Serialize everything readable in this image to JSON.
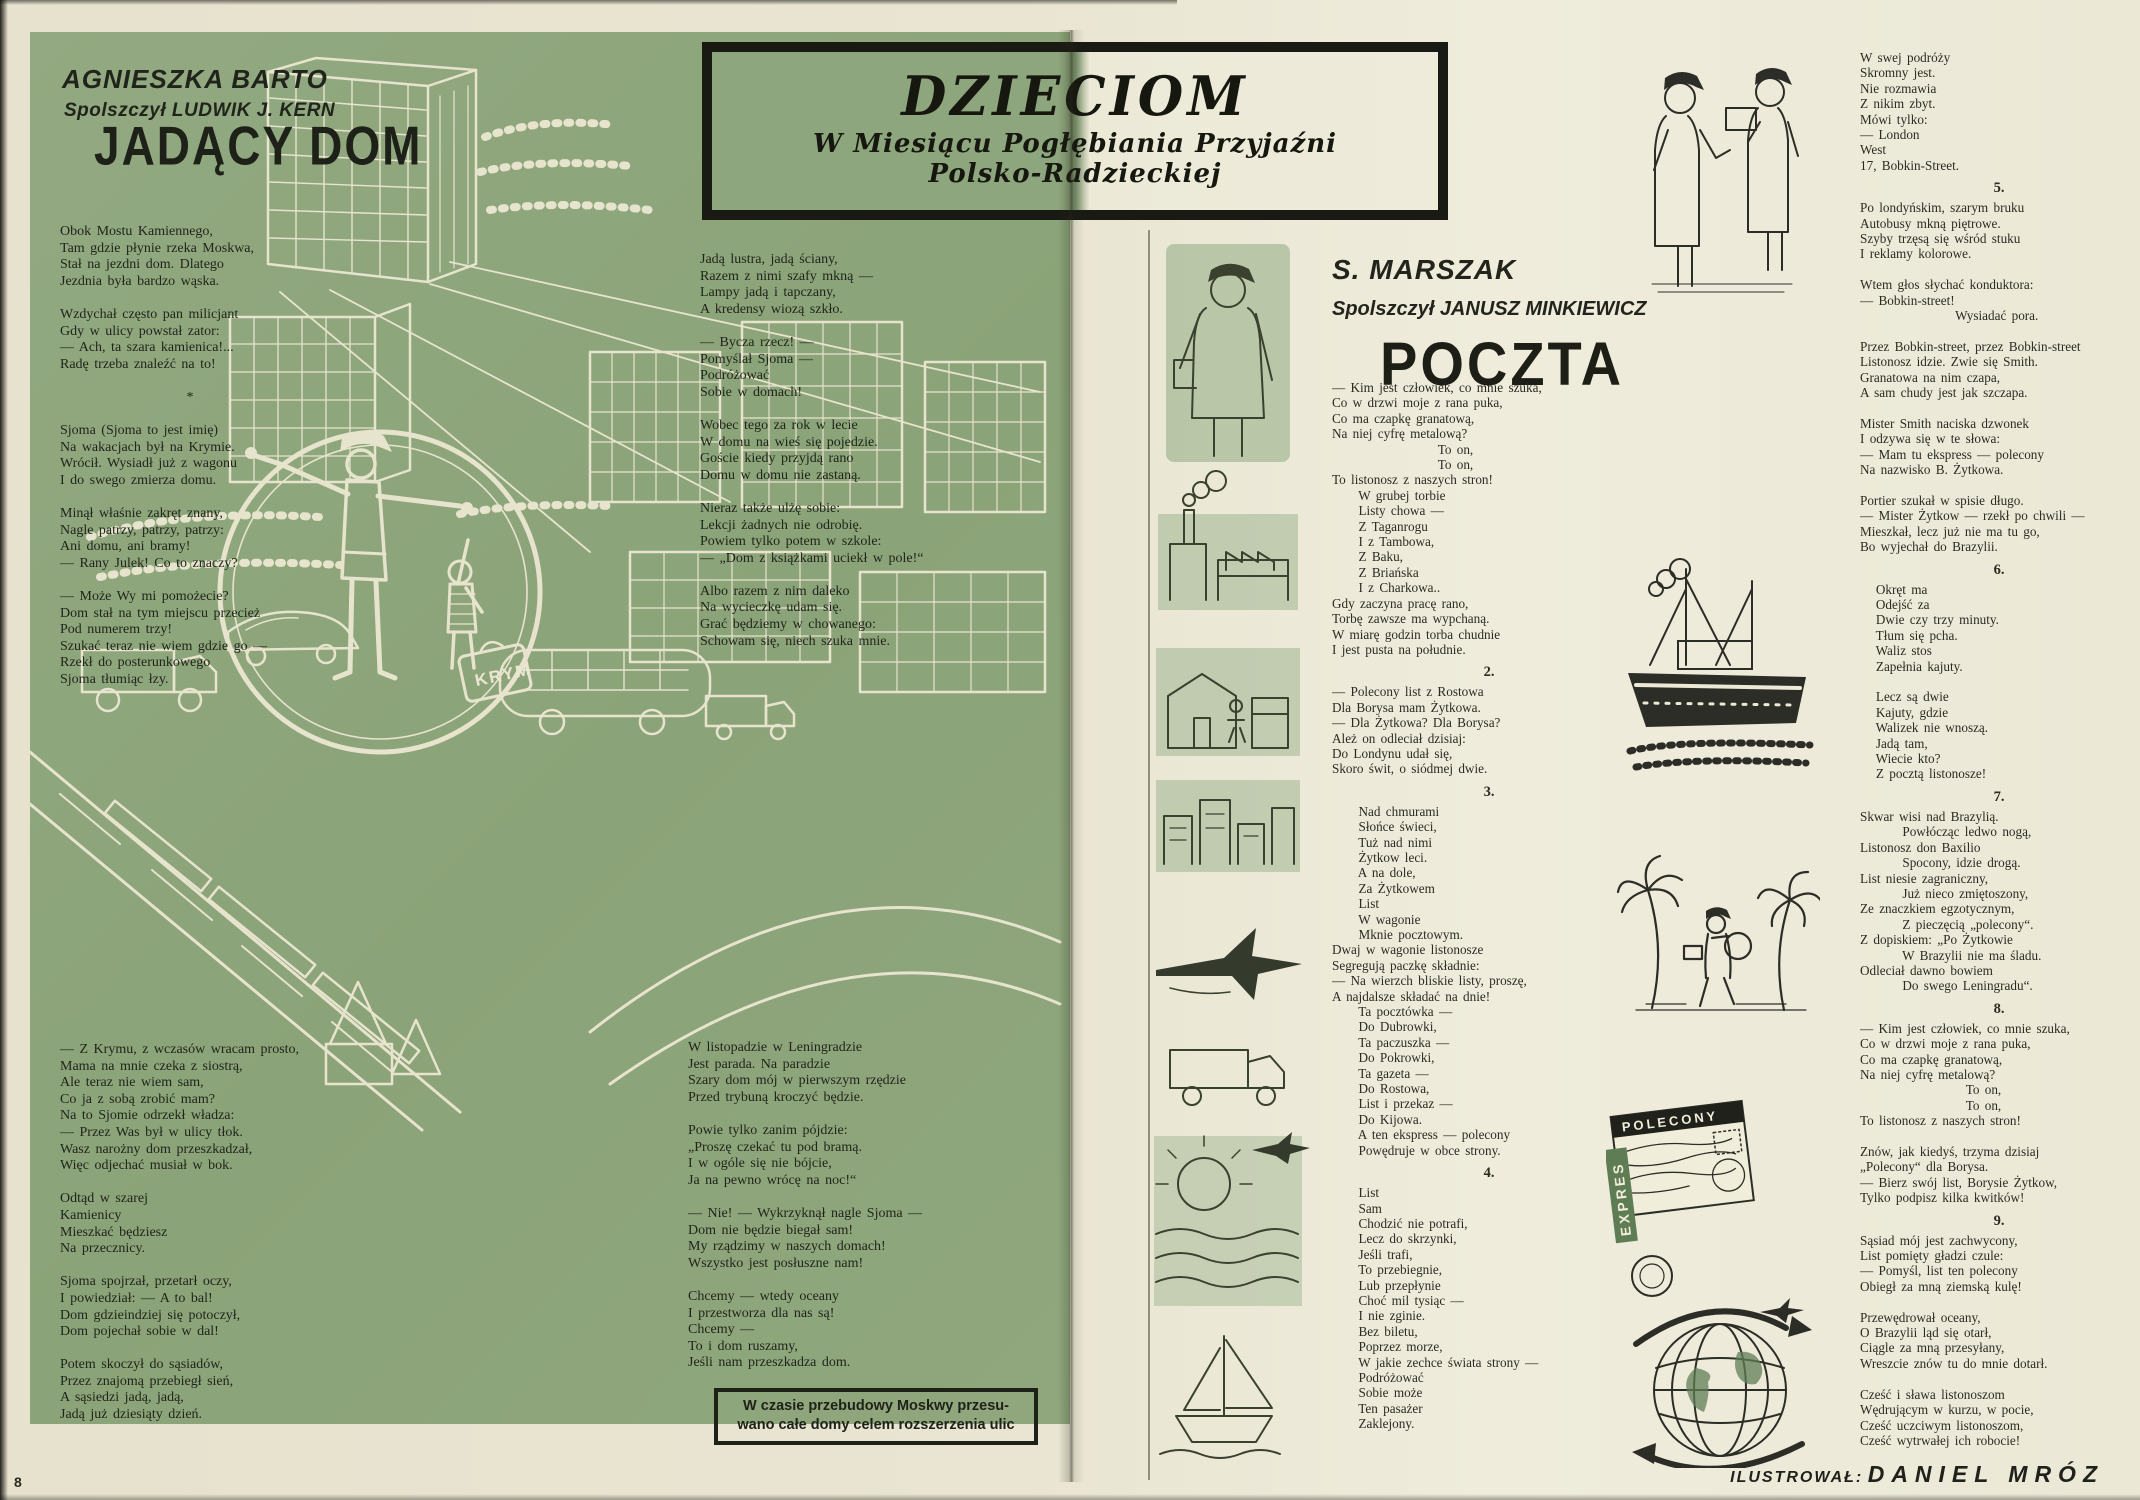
{
  "page": {
    "number": "8",
    "illustrator_label": "ILUSTROWAŁ:",
    "illustrator_name": "DANIEL MRÓZ"
  },
  "banner": {
    "title": "DZIECIOM",
    "subtitle_line1": "W Miesiącu Pogłębiania Przyjaźni",
    "subtitle_line2": "Polsko-Radzieckiej"
  },
  "left_article": {
    "author": "AGNIESZKA BARTO",
    "translator": "Spolszczył LUDWIK J. KERN",
    "title": "JADĄCY DOM",
    "col1_top": "Obok Mostu Kamiennego,\nTam gdzie płynie rzeka Moskwa,\nStał na jezdni dom. Dlatego\nJezdnia była bardzo wąska.\n\nWzdychał często pan milicjant\nGdy w ulicy powstał zator:\n— Ach, ta szara kamienica!...\nRadę trzeba znaleźć na to!\n\n                       *\n\nSjoma (Sjoma to jest imię)\nNa wakacjach był na Krymie.\nWrócił. Wysiadł już z wagonu\nI do swego zmierza domu.\n\nMinął właśnie zakręt znany,\nNagle patrzy, patrzy, patrzy:\nAni domu, ani bramy!\n— Rany Julek! Co to znaczy?\n\n— Może Wy mi pomożecie?\nDom stał na tym miejscu przecież\nPod numerem trzy!\nSzukać teraz nie wiem gdzie go —\nRzekł do posterunkowego\nSjoma tłumiąc łzy.",
    "col1_bottom": "— Z Krymu, z wczasów wracam prosto,\nMama na mnie czeka z siostrą,\nAle teraz nie wiem sam,\nCo ja z sobą zrobić mam?\nNa to Sjomie odrzekł władza:\n— Przez Was był w ulicy tłok.\nWasz narożny dom przeszkadzał,\nWięc odjechać musiał w bok.\n\nOdtąd w szarej\nKamienicy\nMieszkać będziesz\nNa przecznicy.\n\nSjoma spojrzał, przetarł oczy,\nI powiedział: — A to bal!\nDom gdzieindziej się potoczył,\nDom pojechał sobie w dal!\n\nPotem skoczył do sąsiadów,\nPrzez znajomą przebiegł sień,\nA sąsiedzi jadą, jadą,\nJadą już dziesiąty dzień.",
    "col2_top": "Jadą lustra, jadą ściany,\nRazem z nimi szafy mkną —\nLampy jadą i tapczany,\nA kredensy wiozą szkło.\n\n— Bycza rzecz! —\nPomyślał Sjoma —\nPodróżować\nSobie w domach!\n\nWobec tego za rok w lecie\nW domu na wieś się pojedzie.\nGoście kiedy przyjdą rano\nDomu w domu nie zastaną.\n\nNieraz także ulżę sobie:\nLekcji żadnych nie odrobię.\nPowiem tylko potem w szkole:\n— „Dom z książkami uciekł w pole!“",
    "col2_mid": "Albo razem z nim daleko\nNa wycieczkę udam się.\nGrać będziemy w chowanego:\nSchowam się, niech szuka mnie.",
    "col2_bottom": "W listopadzie w Leningradzie\nJest parada. Na paradzie\nSzary dom mój w pierwszym rzędzie\nPrzed trybuną kroczyć będzie.\n\nPowie tylko zanim pójdzie:\n„Proszę czekać tu pod bramą.\nI w ogóle się nie bójcie,\nJa na pewno wrócę na noc!“\n\n— Nie! — Wykrzyknął nagle Sjoma —\nDom nie będzie biegał sam!\nMy rządzimy w naszych domach!\nWszystko jest posłuszne nam!\n\nChcemy — wtedy oceany\nI przestworza dla nas są!\nChcemy —\nTo i dom ruszamy,\nJeśli nam przeszkadza dom.",
    "caption": "W czasie przebudowy Moskwy przesu-\nwano całe domy celem rozszerzenia ulic"
  },
  "right_article": {
    "author": "S. MARSZAK",
    "translator": "Spolszczył JANUSZ MINKIEWICZ",
    "title": "POCZTA",
    "col1": [
      {
        "num": "",
        "text": "— Kim jest człowiek, co mnie szuka,\nCo w drzwi moje z rana puka,\nCo ma czapkę granatową,\nNa niej cyfrę metalową?\n                    To on,\n                    To on,\nTo listonosz z naszych stron!\n     W grubej torbie\n     Listy chowa —\n     Z Taganrogu\n     I z Tambowa,\n     Z Baku,\n     Z Briańska\n     I z Charkowa..\nGdy zaczyna pracę rano,\nTorbę zawsze ma wypchaną.\nW miarę godzin torba chudnie\nI jest pusta na południe."
      },
      {
        "num": "2.",
        "text": "— Polecony list z Rostowa\nDla Borysa mam Żytkowa.\n— Dla Żytkowa? Dla Borysa?\nAleż on odleciał dzisiaj:\nDo Londynu udał się,\nSkoro świt, o siódmej dwie."
      },
      {
        "num": "3.",
        "text": "     Nad chmurami\n     Słońce świeci,\n     Tuż nad nimi\n     Żytkow leci.\n     A na dole,\n     Za Żytkowem\n     List\n     W wagonie\n     Mknie pocztowym.\nDwaj w wagonie listonosze\nSegregują paczkę składnie:\n— Na wierzch bliskie listy, proszę,\nA najdalsze składać na dnie!\n     Ta pocztówka —\n     Do Dubrowki,\n     Ta paczuszka —\n     Do Pokrowki,\n     Ta gazeta —\n     Do Rostowa,\n     List i przekaz —\n     Do Kijowa.\n     A ten ekspress — polecony\n     Powędruje w obce strony."
      },
      {
        "num": "4.",
        "text": "     List\n     Sam\n     Chodzić nie potrafi,\n     Lecz do skrzynki,\n     Jeśli trafi,\n     To przebiegnie,\n     Lub przepłynie\n     Choć mil tysiąc —\n     I nie zginie.\n     Bez biletu,\n     Poprzez morze,\n     W jakie zechce świata strony —\n     Podróżować\n     Sobie może\n     Ten pasażer\n     Zaklejony."
      }
    ],
    "col2": [
      {
        "num": "",
        "text": "W swej podróży\nSkromny jest.\nNie rozmawia\nZ nikim zbyt.\nMówi tylko:\n— London\nWest\n17, Bobkin-Street."
      },
      {
        "num": "5.",
        "text": "Po londyńskim, szarym bruku\nAutobusy mkną piętrowe.\nSzyby trzęsą się wśród stuku\nI reklamy kolorowe.\n\nWtem głos słychać konduktora:\n— Bobkin-street!\n                  Wysiadać pora.\n\nPrzez Bobkin-street, przez Bobkin-street\nListonosz idzie. Zwie się Smith.\nGranatowa na nim czapa,\nA sam chudy jest jak szczapa.\n\nMister Smith naciska dzwonek\nI odzywa się w te słowa:\n— Mam tu ekspress — polecony\nNa nazwisko B. Żytkowa.\n\nPortier szukał w spisie długo.\n— Mister Żytkow — rzekł po chwili —\nMieszkał, lecz już nie ma tu go,\nBo wyjechał do Brazylii."
      },
      {
        "num": "6.",
        "text": "   Okręt ma\n   Odejść za\n   Dwie czy trzy minuty.\n   Tłum się pcha.\n   Waliz stos\n   Zapełnia kajuty.\n\n   Lecz są dwie\n   Kajuty, gdzie\n   Walizek nie wnoszą.\n   Jadą tam,\n   Wiecie kto?\n   Z pocztą listonosze!"
      },
      {
        "num": "7.",
        "text": "Skwar wisi nad Brazylią.\n        Powłócząc ledwo nogą,\nListonosz don Baxilio\n        Spocony, idzie drogą.\nList niesie zagraniczny,\n        Już nieco zmiętoszony,\nZe znaczkiem egzotycznym,\n        Z pieczęcią „polecony“.\nZ dopiskiem: „Po Żytkowie\n        W Brazylii nie ma śladu.\nOdleciał dawno bowiem\n        Do swego Leningradu“."
      },
      {
        "num": "8.",
        "text": "— Kim jest człowiek, co mnie szuka,\nCo w drzwi moje z rana puka,\nCo ma czapkę granatową,\nNa niej cyfrę metalową?\n                    To on,\n                    To on,\nTo listonosz z naszych stron!\n\nZnów, jak kiedyś, trzyma dzisiaj\n„Polecony“ dla Borysa.\n— Bierz swój list, Borysie Żytkow,\nTylko podpisz kilka kwitków!"
      },
      {
        "num": "9.",
        "text": "Sąsiad mój jest zachwycony,\nList pomięty gładzi czule:\n— Pomyśl, list ten polecony\nObiegł za mną ziemską kulę!\n\nPrzewędrował oceany,\nO Brazylii ląd się otarł,\nCiągle za mną przesyłany,\nWreszcie znów tu do mnie dotarł.\n\nCześć i sława listonoszom\nWędrującym w kurzu, w pocie,\nCześć uczciwym listonoszom,\nCześć wytrwałej ich robocie!"
      }
    ]
  },
  "illustrations": {
    "suitcase_label": "KRYM",
    "stamp_registered": "POLECONY",
    "stamp_express": "EXPRES"
  },
  "colors": {
    "page_green": "#8ba378",
    "paper_cream": "#e9e5d2",
    "ink": "#23241c",
    "line_art": "#ece7d2"
  }
}
